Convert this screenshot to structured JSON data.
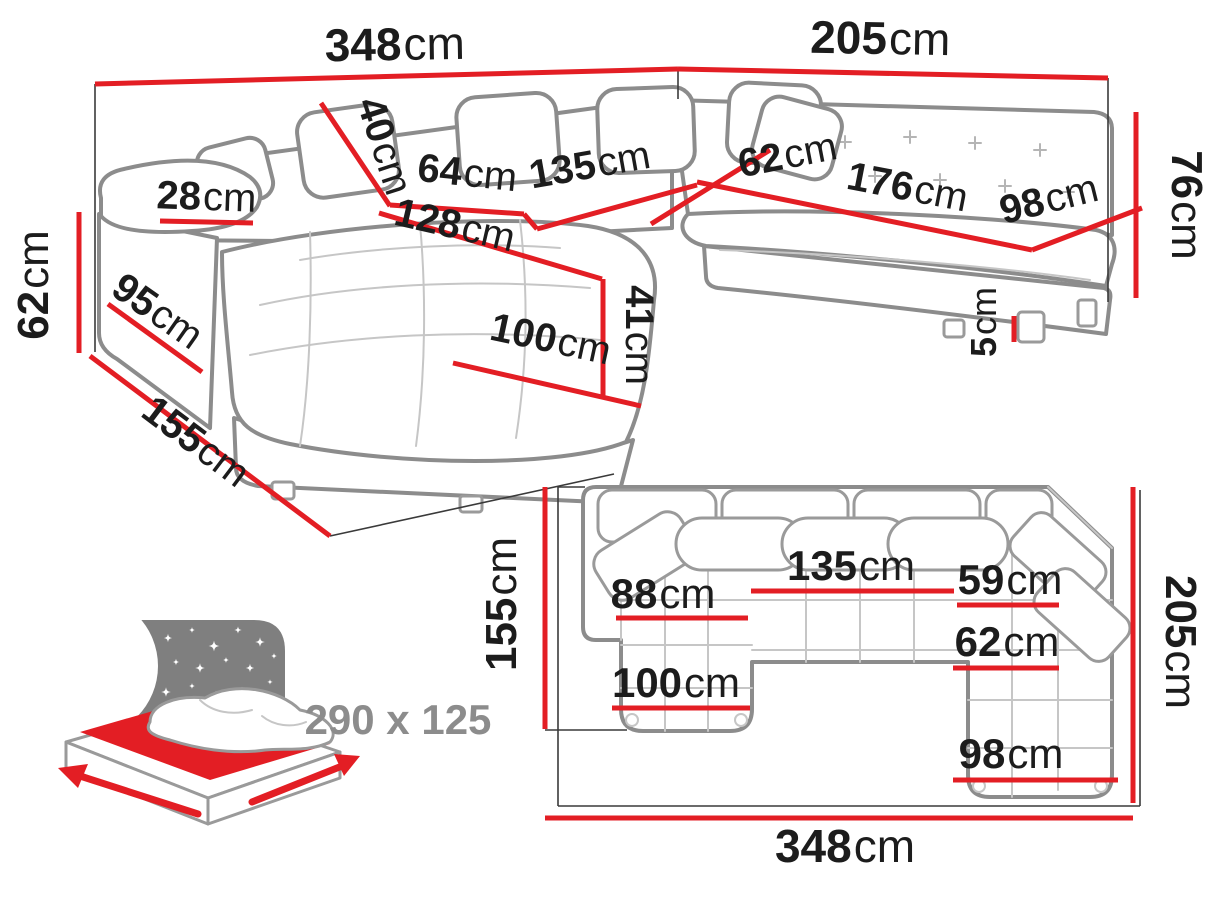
{
  "diagram_type": "sofa dimension diagram",
  "colors": {
    "dimension_red": "#e31e24",
    "outline_gray": "#8c8c8c",
    "text_black": "#1c1c1c",
    "sleeping_label_gray": "#8c8c8c",
    "headboard_panel_gray": "#7f7f7f"
  },
  "perspective": {
    "total_width_left": {
      "value": "348",
      "unit": "cm"
    },
    "total_width_right": {
      "value": "205",
      "unit": "cm"
    },
    "backrest_height": {
      "value": "76",
      "unit": "cm"
    },
    "armrest_height": {
      "value": "62",
      "unit": "cm"
    },
    "armrest_width": {
      "value": "28",
      "unit": "cm"
    },
    "armrest_depth": {
      "value": "95",
      "unit": "cm"
    },
    "chaise_total_depth": {
      "value": "155",
      "unit": "cm"
    },
    "back_cushion_height": {
      "value": "40",
      "unit": "cm"
    },
    "seat_depth_left": {
      "value": "64",
      "unit": "cm"
    },
    "center_seat_width": {
      "value": "135",
      "unit": "cm"
    },
    "chaise_length": {
      "value": "128",
      "unit": "cm"
    },
    "chaise_width": {
      "value": "100",
      "unit": "cm"
    },
    "seat_height": {
      "value": "41",
      "unit": "cm"
    },
    "seat_depth_right": {
      "value": "62",
      "unit": "cm"
    },
    "right_seat_length": {
      "value": "176",
      "unit": "cm"
    },
    "end_seat_width": {
      "value": "98",
      "unit": "cm"
    },
    "leg_height": {
      "value": "5",
      "unit": "cm"
    }
  },
  "plan": {
    "left_depth": {
      "value": "155",
      "unit": "cm"
    },
    "right_depth": {
      "value": "205",
      "unit": "cm"
    },
    "total_width": {
      "value": "348",
      "unit": "cm"
    },
    "chaise_back_width": {
      "value": "88",
      "unit": "cm"
    },
    "center_width": {
      "value": "135",
      "unit": "cm"
    },
    "right_seat_top_width": {
      "value": "59",
      "unit": "cm"
    },
    "right_seat_width": {
      "value": "62",
      "unit": "cm"
    },
    "chaise_front_width": {
      "value": "100",
      "unit": "cm"
    },
    "end_seat_width": {
      "value": "98",
      "unit": "cm"
    }
  },
  "sleeping_area": {
    "label": "290 x 125"
  }
}
